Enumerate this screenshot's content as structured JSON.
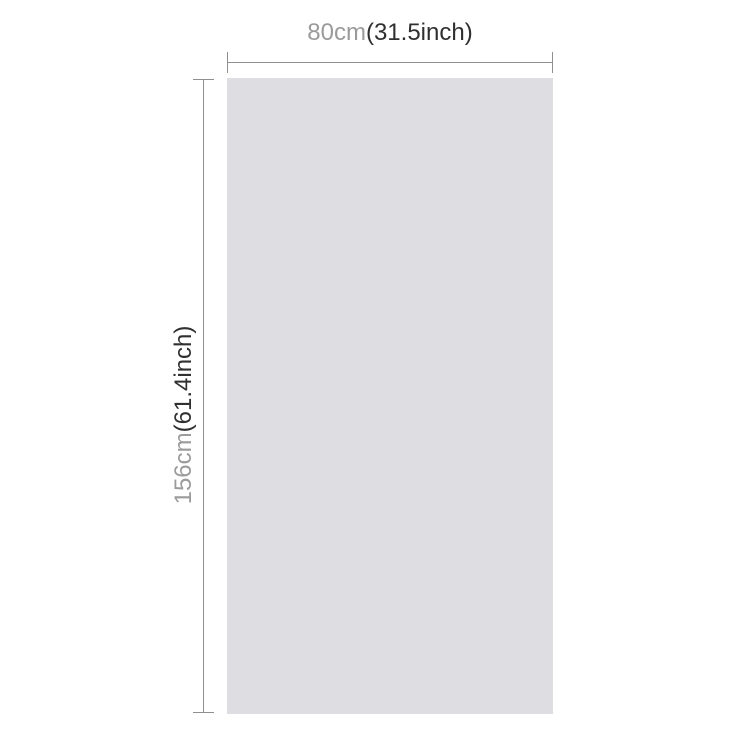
{
  "diagram": {
    "kind": "product-dimension-diagram"
  },
  "width_dimension": {
    "metric": "80cm",
    "imperial": "(31.5inch)"
  },
  "height_dimension": {
    "metric": "156cm",
    "imperial": "(61.4inch)"
  },
  "colors": {
    "canvas_bg": "#ffffff",
    "product_fill": "#dedde2",
    "dimension_line": "#8f8f8f",
    "metric_text": "#9b9b9b",
    "imperial_text": "#303030"
  }
}
